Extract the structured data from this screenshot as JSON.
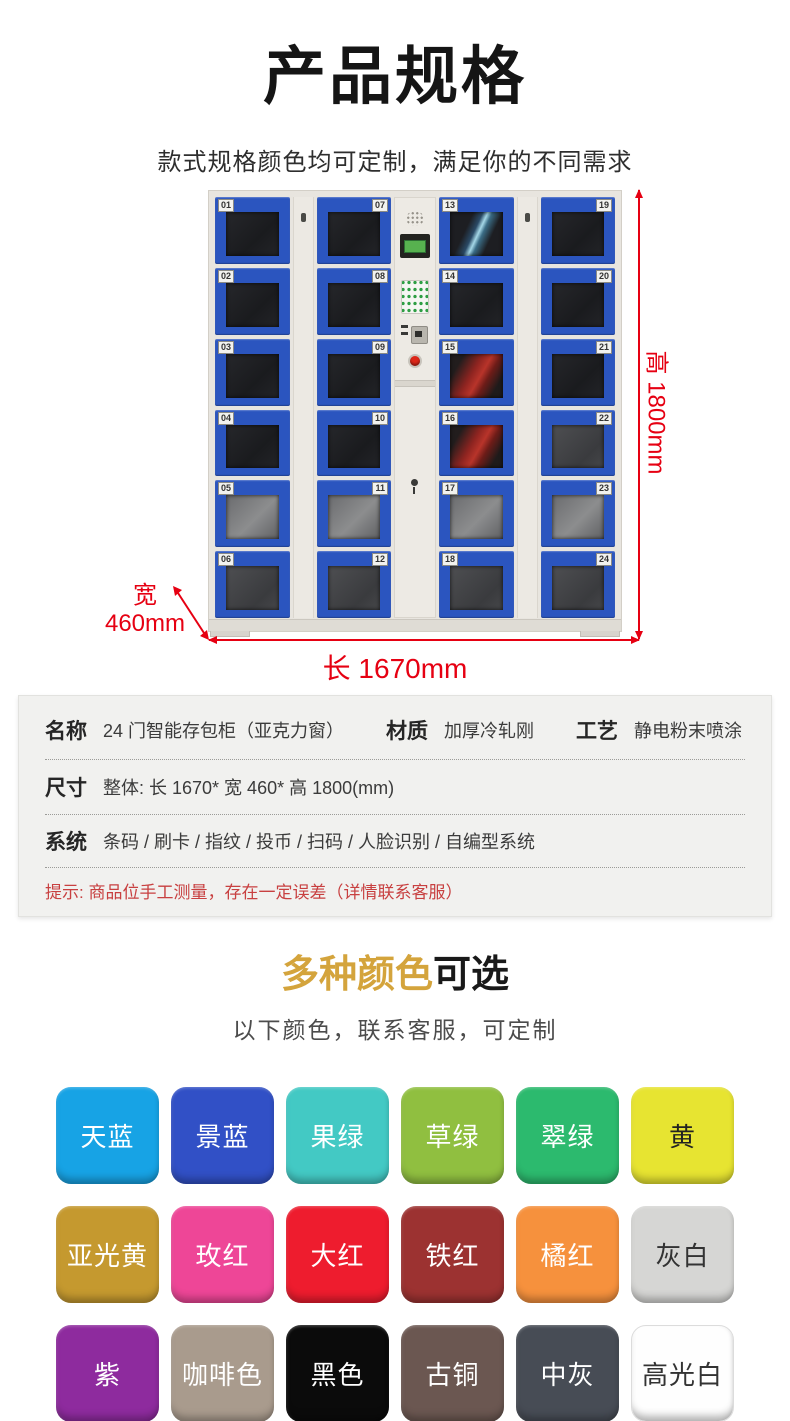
{
  "page": {
    "title": "产品规格",
    "subtitle": "款式规格颜色均可定制，满足你的不同需求"
  },
  "locker": {
    "columns": [
      {
        "label_side": "left",
        "doors": [
          "01",
          "02",
          "03",
          "04",
          "05",
          "06"
        ]
      },
      {
        "label_side": "right",
        "doors": [
          "07",
          "08",
          "09",
          "10",
          "11",
          "12"
        ]
      },
      {
        "label_side": "left",
        "doors": [
          "13",
          "14",
          "15",
          "16",
          "17",
          "18"
        ]
      },
      {
        "label_side": "right",
        "doors": [
          "19",
          "20",
          "21",
          "22",
          "23",
          "24"
        ]
      }
    ],
    "dimensions": {
      "height_label": "高 1800mm",
      "width_label_cn": "宽",
      "width_label_val": "460mm",
      "length_label": "长 1670mm",
      "accent_red": "#E60012"
    }
  },
  "spec_table": {
    "name_label": "名称",
    "name_value": "24 门智能存包柜（亚克力窗）",
    "material_label": "材质",
    "material_value": "加厚冷轧刚",
    "craft_label": "工艺",
    "craft_value": "静电粉末喷涂",
    "size_label": "尺寸",
    "size_value": "整体: 长 1670* 宽 460* 高 1800(mm)",
    "system_label": "系统",
    "system_value": "条码 / 刷卡 / 指纹 / 投币 / 扫码 / 人脸识别 / 自编型系统",
    "notice": "提示: 商品位手工测量，存在一定误差（详情联系客服）",
    "notice_color": "#C84040"
  },
  "colors_section": {
    "title_highlight": "多种颜色",
    "title_rest": "可选",
    "highlight_color": "#D4A43C",
    "subtitle": "以下颜色，联系客服，可定制",
    "swatches": [
      {
        "name": "天蓝",
        "bg": "#17A3E5",
        "text": "#ffffff"
      },
      {
        "name": "景蓝",
        "bg": "#3150C6",
        "text": "#ffffff"
      },
      {
        "name": "果绿",
        "bg": "#43C9C4",
        "text": "#ffffff"
      },
      {
        "name": "草绿",
        "bg": "#90BF40",
        "text": "#ffffff"
      },
      {
        "name": "翠绿",
        "bg": "#2CBA6E",
        "text": "#ffffff"
      },
      {
        "name": "黄",
        "bg": "#E7E431",
        "text": "#222222"
      },
      {
        "name": "亚光黄",
        "bg": "#C5992F",
        "text": "#ffffff"
      },
      {
        "name": "玫红",
        "bg": "#EE4697",
        "text": "#ffffff"
      },
      {
        "name": "大红",
        "bg": "#EE1C2E",
        "text": "#ffffff"
      },
      {
        "name": "铁红",
        "bg": "#9C3231",
        "text": "#ffffff"
      },
      {
        "name": "橘红",
        "bg": "#F6913D",
        "text": "#ffffff"
      },
      {
        "name": "灰白",
        "bg": "#D6D6D4",
        "text": "#333333"
      },
      {
        "name": "紫",
        "bg": "#8E2B9E",
        "text": "#ffffff"
      },
      {
        "name": "咖啡色",
        "bg": "#A99B8D",
        "text": "#ffffff"
      },
      {
        "name": "黑色",
        "bg": "#0B0B0B",
        "text": "#ffffff"
      },
      {
        "name": "古铜",
        "bg": "#6B5751",
        "text": "#ffffff"
      },
      {
        "name": "中灰",
        "bg": "#474C55",
        "text": "#ffffff"
      },
      {
        "name": "高光白",
        "bg": "#FEFEFE",
        "text": "#333333",
        "border": "#DCDCDC"
      }
    ]
  }
}
